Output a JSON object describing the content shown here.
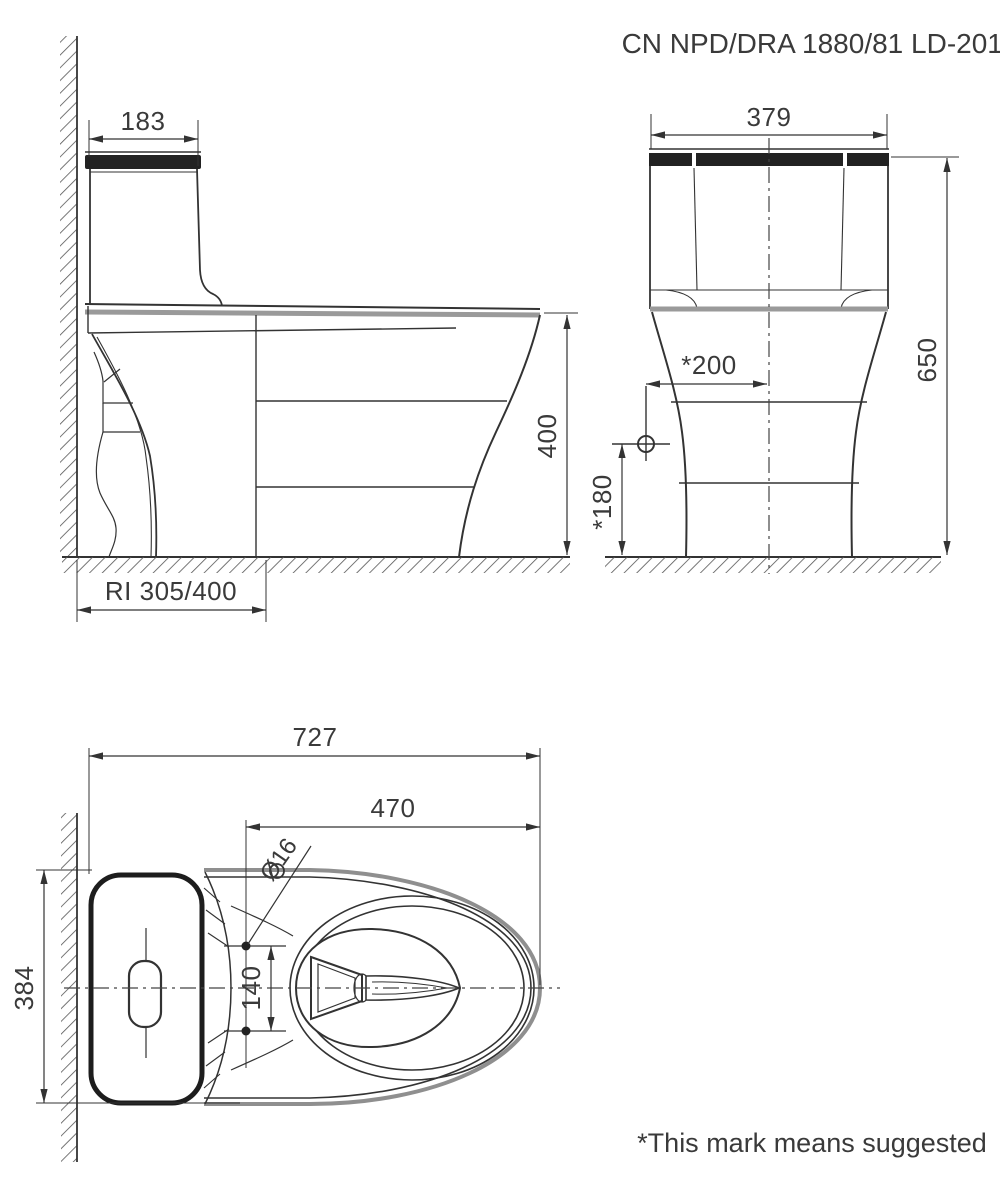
{
  "drawing": {
    "code": "CN NPD/DRA 1880/81 LD-2018",
    "footnote": "*This mark means suggested",
    "side_view": {
      "tank_top_width": "183",
      "bowl_height": "400",
      "rough_in": "RI 305/400"
    },
    "front_view": {
      "tank_width": "379",
      "total_height": "650",
      "supply_horizontal": "*200",
      "supply_vertical": "*180"
    },
    "top_view": {
      "total_length": "727",
      "bolt_to_front": "470",
      "bolt_hole_diameter": "Ø16",
      "overall_width": "384",
      "bolt_spacing": "140"
    }
  }
}
